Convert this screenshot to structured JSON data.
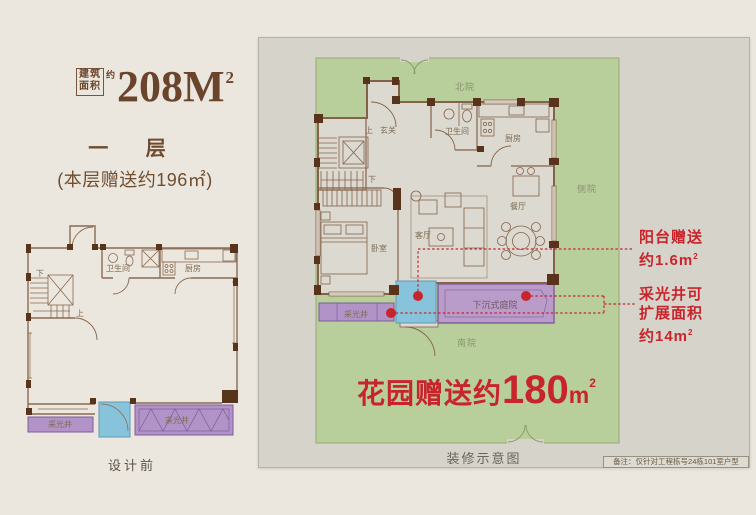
{
  "title": {
    "box_row1": "建筑",
    "box_row2": "面积",
    "approx": "约",
    "value": "208M",
    "sup": "2"
  },
  "left": {
    "floor": "一 层",
    "gift": "(本层赠送约196㎡)",
    "caption": "设计前",
    "labels": {
      "bathroom": "卫生间",
      "kitchen": "厨房",
      "down": "下",
      "up": "上",
      "lightwell_a": "采光井",
      "lightwell_b": "采光井"
    }
  },
  "plan": {
    "yards": {
      "north": "北院",
      "side": "侧院",
      "south": "南院"
    },
    "rooms": {
      "up": "上",
      "entry": "玄关",
      "bath": "卫生间",
      "kitchen": "厨房",
      "down": "下",
      "dining": "餐厅",
      "living": "客厅",
      "bedroom": "卧室",
      "lightwell": "采光井",
      "courtyard": "下沉式庭院"
    },
    "caption": "装修示意图",
    "note": "备注：仅针对工程栋号24栋101室户型"
  },
  "annotations": {
    "balcony_l1": "阳台赠送",
    "balcony_l2": "约1.6m",
    "balcony_sup": "2",
    "lightwell_l1": "采光井可",
    "lightwell_l2": "扩展面积",
    "lightwell_l3": "约14m",
    "lightwell_sup": "2",
    "garden_text": "花园赠送约",
    "garden_value": "180",
    "garden_unit": "m",
    "garden_sup": "2"
  },
  "colors": {
    "accent_red": "#c8242c",
    "garden_green": "#b8cf9b",
    "purple": "#b293c7",
    "blue": "#87c4dc",
    "brown_text": "#6e4b2e",
    "panel_grey": "#d6d3ca",
    "wall_brown": "#84624a"
  }
}
